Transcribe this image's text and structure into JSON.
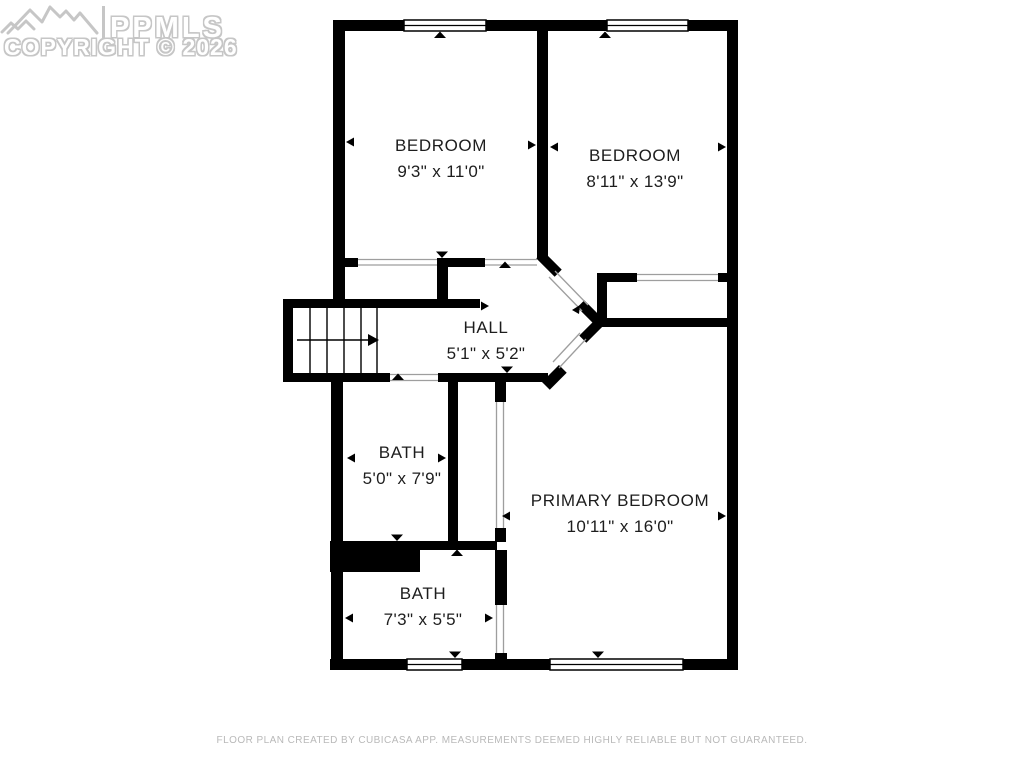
{
  "watermark": {
    "brand": "PPMLS",
    "copyright": "COPYRIGHT © 2026",
    "logo": "mountain-range-icon"
  },
  "rooms": [
    {
      "id": "bedroom-1",
      "name": "BEDROOM",
      "dimensions": "9'3\" x 11'0\""
    },
    {
      "id": "bedroom-2",
      "name": "BEDROOM",
      "dimensions": "8'11\" x 13'9\""
    },
    {
      "id": "hall",
      "name": "HALL",
      "dimensions": "5'1\" x 5'2\""
    },
    {
      "id": "bath-upper",
      "name": "BATH",
      "dimensions": "5'0\" x 7'9\""
    },
    {
      "id": "primary-bedroom",
      "name": "PRIMARY BEDROOM",
      "dimensions": "10'11\" x 16'0\""
    },
    {
      "id": "bath-lower",
      "name": "BATH",
      "dimensions": "7'3\" x 5'5\""
    }
  ],
  "footer": {
    "disclaimer": "FLOOR PLAN CREATED BY CUBICASA APP. MEASUREMENTS DEEMED HIGHLY RELIABLE BUT NOT GUARANTEED."
  },
  "colors": {
    "wall": "#000000",
    "background": "#ffffff",
    "label_text": "#1d1d1d",
    "watermark_gray": "#c6c6c6",
    "footer_gray": "#b9b9b9",
    "opening_line": "#9e9e9e"
  }
}
